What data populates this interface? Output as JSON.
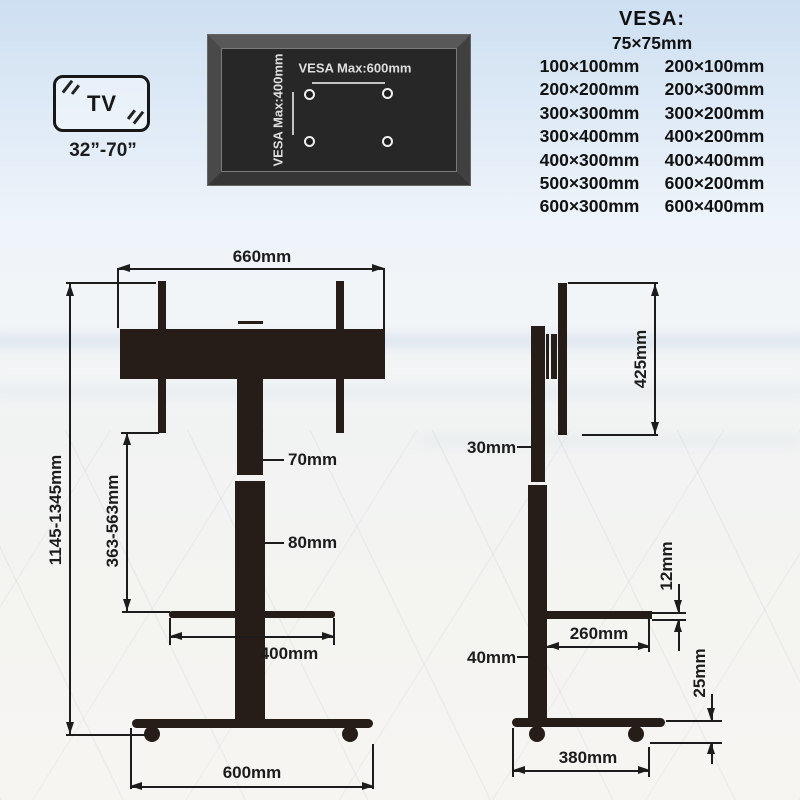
{
  "tv_badge": {
    "label": "TV",
    "size_range": "32”-70”"
  },
  "vesa_plate": {
    "max_width": "VESA Max:600mm",
    "max_height": "VESA Max:400mm"
  },
  "vesa_list": {
    "title": "VESA:",
    "top_size": "75×75mm",
    "rows": [
      [
        "100×100mm",
        "200×100mm"
      ],
      [
        "200×200mm",
        "200×300mm"
      ],
      [
        "300×300mm",
        "300×200mm"
      ],
      [
        "300×400mm",
        "400×200mm"
      ],
      [
        "400×300mm",
        "400×400mm"
      ],
      [
        "500×300mm",
        "600×200mm"
      ],
      [
        "600×300mm",
        "600×400mm"
      ]
    ]
  },
  "front_view": {
    "top_width": "660mm",
    "total_height": "1145-1345mm",
    "lift_range": "363-563mm",
    "upper_column_width": "70mm",
    "lower_column_width": "80mm",
    "shelf_width": "400mm",
    "base_width": "600mm"
  },
  "side_view": {
    "bracket_height": "425mm",
    "upper_column_depth": "30mm",
    "shelf_thickness": "12mm",
    "shelf_depth": "260mm",
    "lower_column_depth": "40mm",
    "base_height": "25mm",
    "base_depth": "380mm"
  },
  "colors": {
    "stand_dark": "#261d18",
    "line": "#1c1c1c",
    "plate_panel": "#272727",
    "plate_text": "#dedede",
    "sky_top": "#cddff2"
  }
}
